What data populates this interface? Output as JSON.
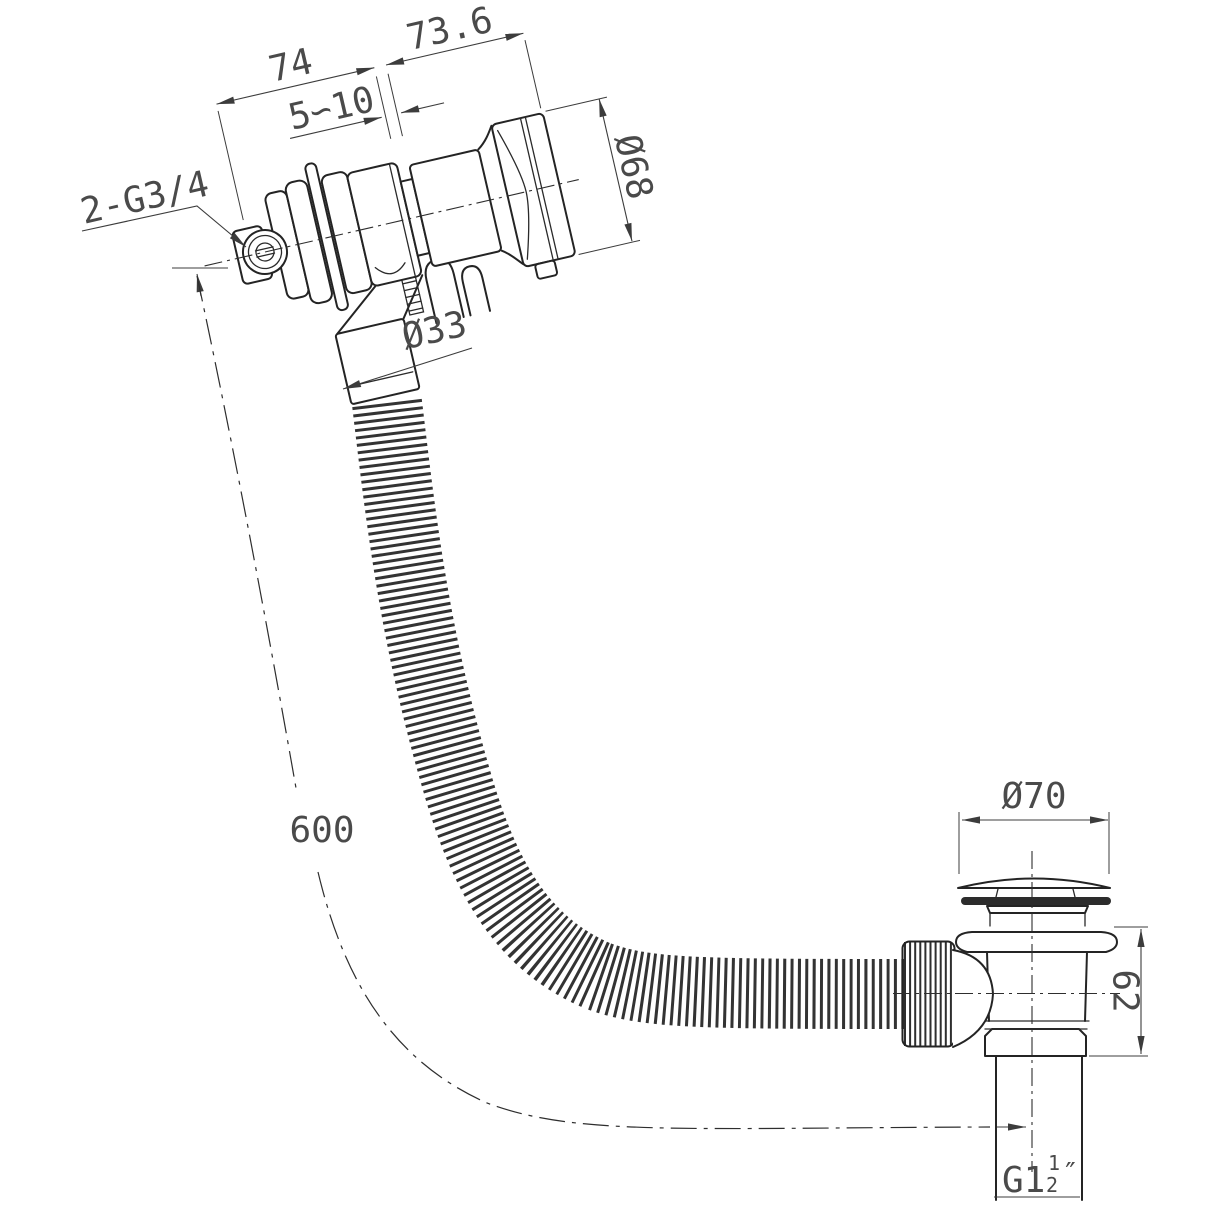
{
  "drawing": {
    "type": "technical-drawing",
    "views": [
      "overflow-filler-with-hose",
      "waste-drain"
    ],
    "line_color": "#242424",
    "dim_color": "#4a4a4a",
    "background": "#ffffff"
  },
  "dimensions": {
    "flange_to_end": "74",
    "head_length": "73.6",
    "mount_range": "5∽10",
    "head_diameter": "Ø68",
    "inlet_thread": "2-G3/4",
    "hose_diameter": "Ø33",
    "hose_length": "600",
    "cap_diameter": "Ø70",
    "waste_height": "62",
    "tail_thread": {
      "prefix": "G1",
      "numerator": "1",
      "denominator": "2",
      "unit": "″"
    }
  }
}
